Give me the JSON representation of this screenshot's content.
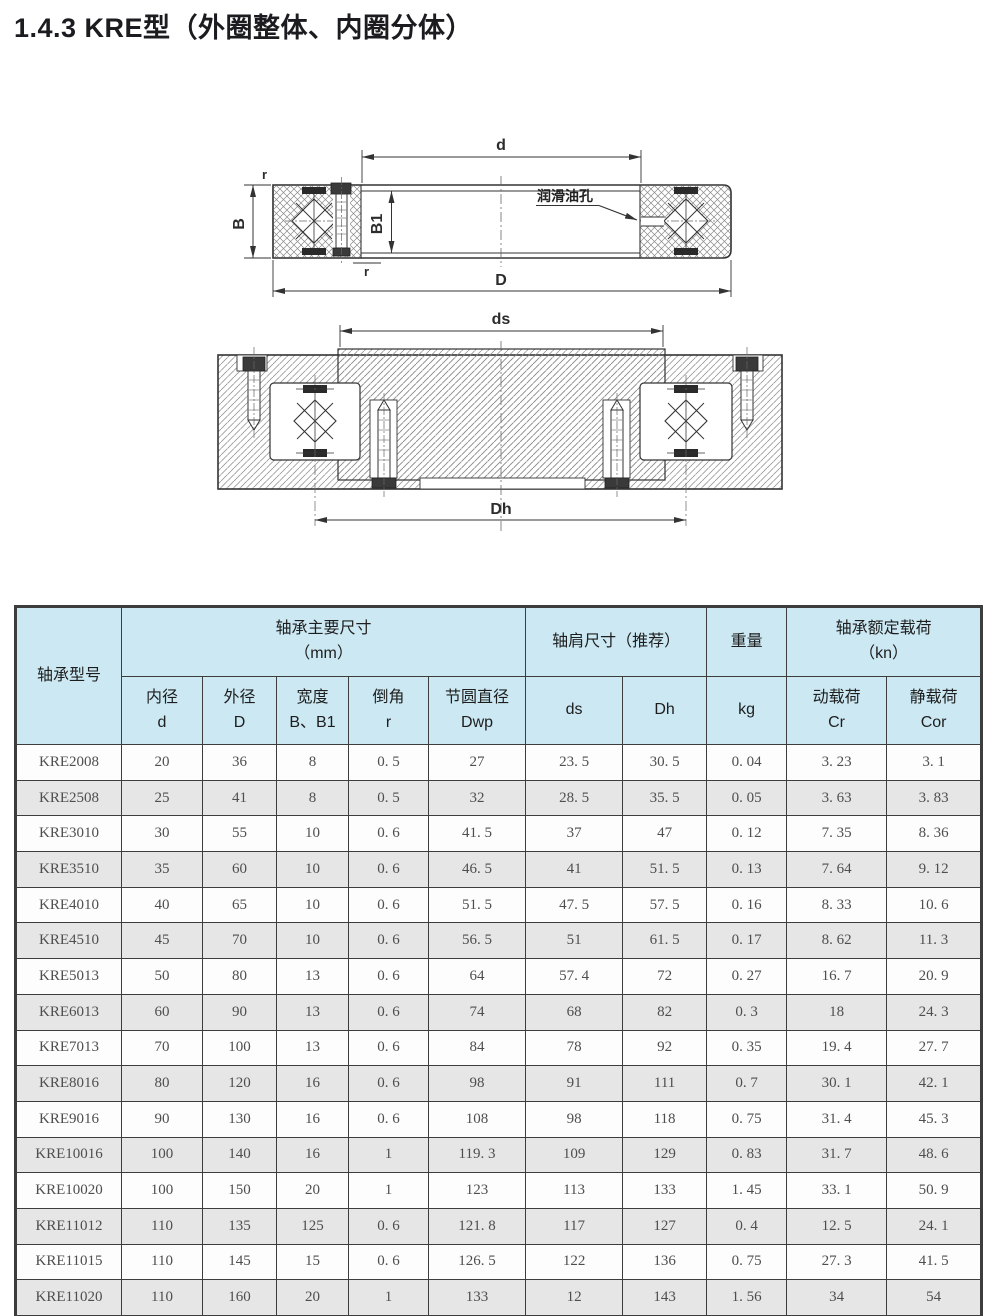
{
  "page": {
    "title": "1.4.3 KRE型（外圈整体、内圈分体）"
  },
  "drawing": {
    "section_view": {
      "dim_d": "d",
      "dim_D": "D",
      "dim_B": "B",
      "dim_B1": "B1",
      "r_top": "r",
      "r_bottom": "r",
      "oil_hole_label": "润滑油孔"
    },
    "mounting_view": {
      "dim_ds": "ds",
      "dim_Dh": "Dh"
    }
  },
  "table": {
    "headers": {
      "model": "轴承型号",
      "main_dims_title": "轴承主要尺寸",
      "main_dims_unit": "（mm）",
      "shoulder_title": "轴肩尺寸（推荐）",
      "weight_title": "重量",
      "load_title": "轴承额定载荷",
      "load_unit": "（kn）",
      "sub": [
        {
          "l1": "内径",
          "l2": "d"
        },
        {
          "l1": "外径",
          "l2": "D"
        },
        {
          "l1": "宽度",
          "l2": "B、B1"
        },
        {
          "l1": "倒角",
          "l2": "r"
        },
        {
          "l1": "节圆直径",
          "l2": "Dwp"
        },
        {
          "l1": "",
          "l2": "ds"
        },
        {
          "l1": "",
          "l2": "Dh"
        },
        {
          "l1": "",
          "l2": "kg"
        },
        {
          "l1": "动载荷",
          "l2": "Cr"
        },
        {
          "l1": "静载荷",
          "l2": "Cor"
        }
      ]
    },
    "rows": [
      [
        "KRE2008",
        "20",
        "36",
        "8",
        "0. 5",
        "27",
        "23. 5",
        "30. 5",
        "0. 04",
        "3. 23",
        "3. 1"
      ],
      [
        "KRE2508",
        "25",
        "41",
        "8",
        "0. 5",
        "32",
        "28. 5",
        "35. 5",
        "0. 05",
        "3. 63",
        "3. 83"
      ],
      [
        "KRE3010",
        "30",
        "55",
        "10",
        "0. 6",
        "41. 5",
        "37",
        "47",
        "0. 12",
        "7. 35",
        "8. 36"
      ],
      [
        "KRE3510",
        "35",
        "60",
        "10",
        "0. 6",
        "46. 5",
        "41",
        "51. 5",
        "0. 13",
        "7. 64",
        "9. 12"
      ],
      [
        "KRE4010",
        "40",
        "65",
        "10",
        "0. 6",
        "51. 5",
        "47. 5",
        "57. 5",
        "0. 16",
        "8. 33",
        "10. 6"
      ],
      [
        "KRE4510",
        "45",
        "70",
        "10",
        "0. 6",
        "56. 5",
        "51",
        "61. 5",
        "0. 17",
        "8. 62",
        "11. 3"
      ],
      [
        "KRE5013",
        "50",
        "80",
        "13",
        "0. 6",
        "64",
        "57. 4",
        "72",
        "0. 27",
        "16. 7",
        "20. 9"
      ],
      [
        "KRE6013",
        "60",
        "90",
        "13",
        "0. 6",
        "74",
        "68",
        "82",
        "0. 3",
        "18",
        "24. 3"
      ],
      [
        "KRE7013",
        "70",
        "100",
        "13",
        "0. 6",
        "84",
        "78",
        "92",
        "0. 35",
        "19. 4",
        "27. 7"
      ],
      [
        "KRE8016",
        "80",
        "120",
        "16",
        "0. 6",
        "98",
        "91",
        "111",
        "0. 7",
        "30. 1",
        "42. 1"
      ],
      [
        "KRE9016",
        "90",
        "130",
        "16",
        "0. 6",
        "108",
        "98",
        "118",
        "0. 75",
        "31. 4",
        "45. 3"
      ],
      [
        "KRE10016",
        "100",
        "140",
        "16",
        "1",
        "119. 3",
        "109",
        "129",
        "0. 83",
        "31. 7",
        "48. 6"
      ],
      [
        "KRE10020",
        "100",
        "150",
        "20",
        "1",
        "123",
        "113",
        "133",
        "1. 45",
        "33. 1",
        "50. 9"
      ],
      [
        "KRE11012",
        "110",
        "135",
        "125",
        "0. 6",
        "121. 8",
        "117",
        "127",
        "0. 4",
        "12. 5",
        "24. 1"
      ],
      [
        "KRE11015",
        "110",
        "145",
        "15",
        "0. 6",
        "126. 5",
        "122",
        "136",
        "0. 75",
        "27. 3",
        "41. 5"
      ],
      [
        "KRE11020",
        "110",
        "160",
        "20",
        "1",
        "133",
        "12",
        "143",
        "1. 56",
        "34",
        "54"
      ]
    ]
  },
  "colors": {
    "header_bg": "#cbe8f3",
    "row_alt_bg": "#e6e6e6",
    "border": "#3d3d3d"
  }
}
